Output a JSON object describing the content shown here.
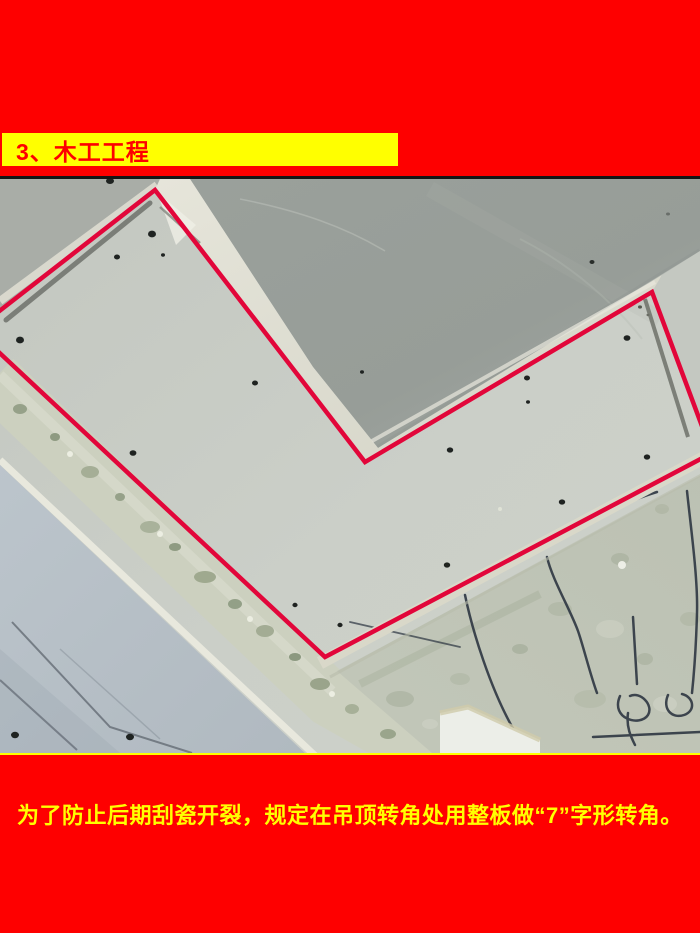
{
  "colors": {
    "background_red": "#fe0000",
    "banner_yellow": "#ffff00",
    "title_red": "#fe0000",
    "caption_yellow": "#ffff00",
    "annotation_red": "#e2063a"
  },
  "header": {
    "title": "3、木工工程"
  },
  "photo": {
    "aria_label": "吊顶转角处用整板做7字形转角的现场照片，红线标注整板轮廓"
  },
  "caption": {
    "text": "为了防止后期刮瓷开裂，规定在吊顶转角处用整板做“7”字形转角。"
  }
}
